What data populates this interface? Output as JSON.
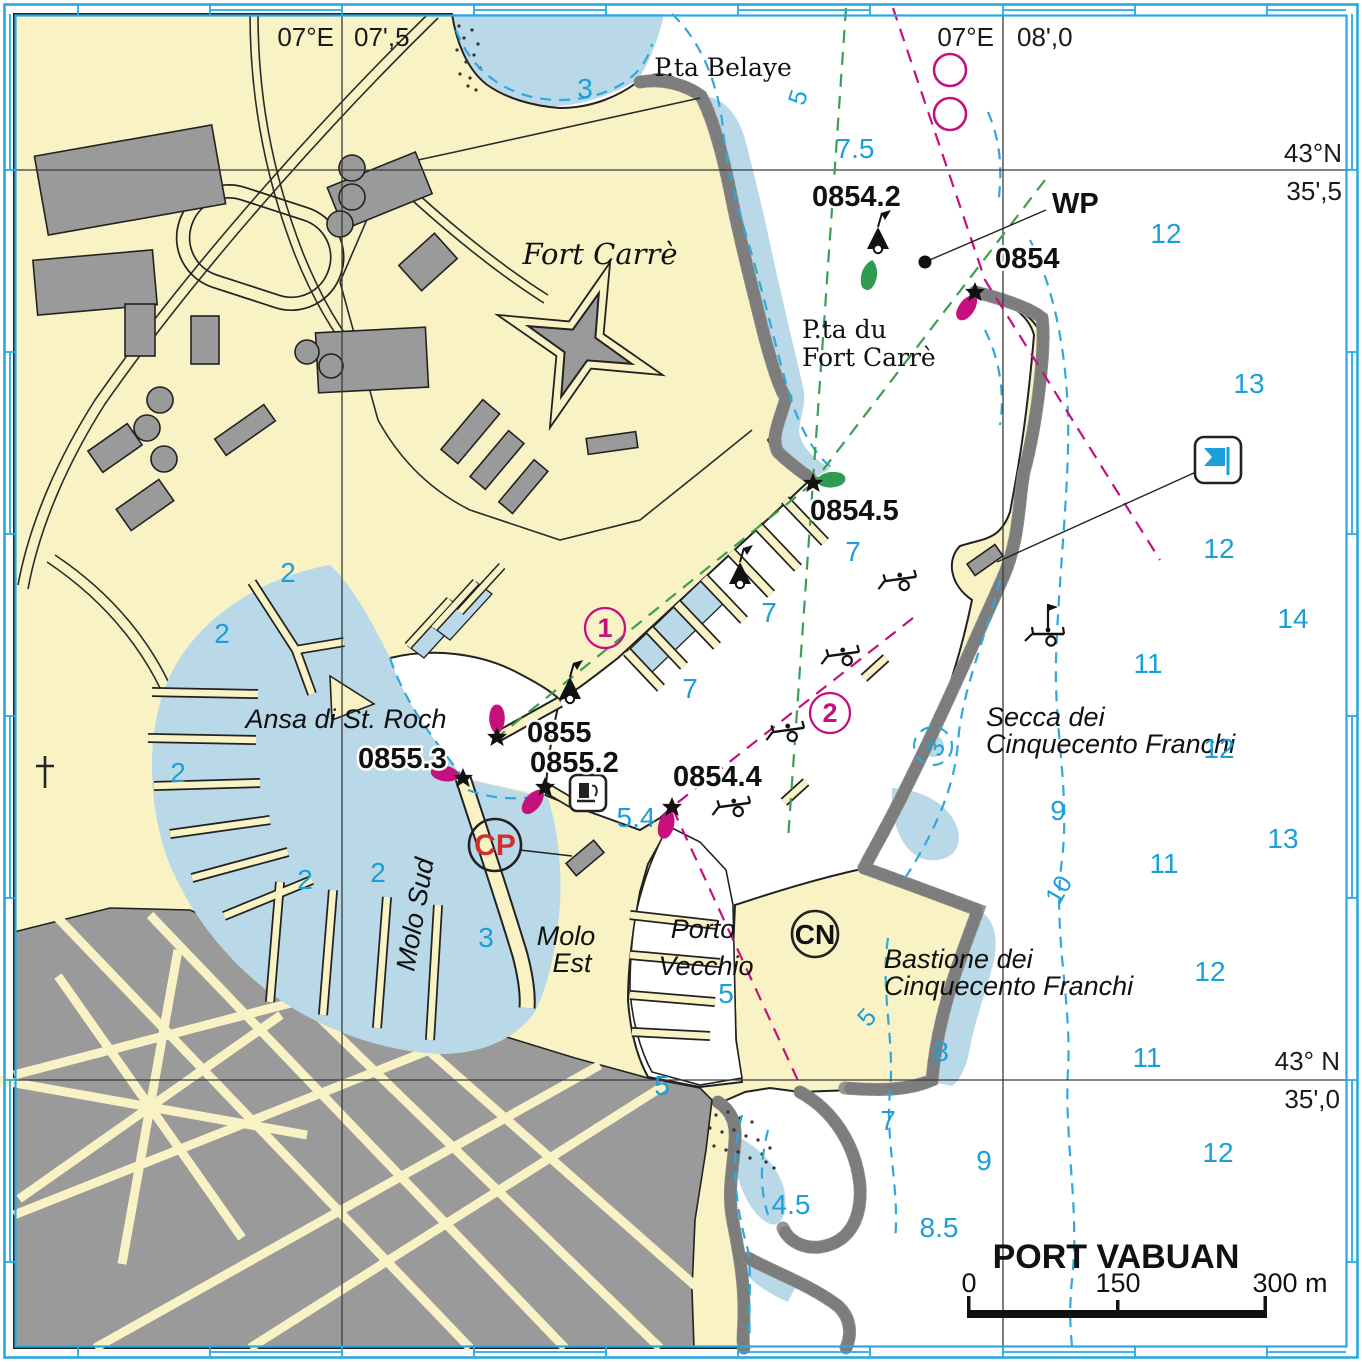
{
  "title": "PORT VABUAN",
  "colors": {
    "land": "#F9F2C4",
    "shallow_water": "#B9D8E8",
    "deep_water": "#FFFFFF",
    "buildings_gray": "#9A9A9A",
    "contour_blue": "#2FA8DC",
    "sounding_blue": "#1C9FD9",
    "magenta": "#C4117D",
    "green_buoy": "#2F9B50",
    "cp_red": "#D03028",
    "border_cyan": "#29A8E0"
  },
  "border_coords": {
    "lon_label_left": "07°E",
    "lon_tick_left": "07',5",
    "lon_label_right": "07°E",
    "lon_tick_right": "08',0",
    "lat_label_top": "43°N",
    "lat_tick_top": "35',5",
    "lat_label_bottom": "43° N",
    "lat_tick_bottom": "35',0"
  },
  "places": {
    "pta_belaye": "P.ta Belaye",
    "fort_carre": "Fort Carrè",
    "pta_du_1": "P.ta du",
    "pta_du_2": "Fort Carrè",
    "ansa": "Ansa di St. Roch",
    "molo_sud": "Molo Sud",
    "molo_est_1": "Molo",
    "molo_est_2": "Est",
    "porto_1": "Porto",
    "porto_2": "Vecchio",
    "secca_1": "Secca dei",
    "secca_2": "Cinquecento Franchi",
    "bastione_1": "Bastione dei",
    "bastione_2": "Cinquecento Franchi"
  },
  "lights": {
    "wp": "WP",
    "b0854": "0854",
    "b0854_2": "0854.2",
    "b0854_4": "0854.4",
    "b0854_5": "0854.5",
    "b0855": "0855",
    "b0855_2": "0855.2",
    "b0855_3": "0855.3"
  },
  "markers": {
    "berth_1": "1",
    "berth_2": "2",
    "cp": "CP",
    "cn": "CN"
  },
  "soundings": [
    "3",
    "7.5",
    "12",
    "13",
    "12",
    "7",
    "7",
    "14",
    "11",
    "7",
    "12",
    "9",
    "13",
    "11",
    "12",
    "8",
    "11",
    "7",
    "9",
    "12",
    "4.5",
    "8.5",
    "5.4",
    "2",
    "2",
    "2",
    "2",
    "2",
    "3",
    "5",
    "5"
  ],
  "contour_labels": [
    "5",
    "3",
    "10",
    "5"
  ],
  "scale_bar": {
    "zero": "0",
    "mid": "150",
    "end": "300 m"
  },
  "icons": {
    "green_conical_buoy": "cone+flag",
    "light_star": "star",
    "light_flare": "teardrop",
    "mooring_trailer": "boat-trailer",
    "fuel_station": "pump",
    "marina_flag": "blue flag",
    "church_cross": "cross",
    "waypoint_dot": "dot",
    "magenta_circle": "circle"
  }
}
